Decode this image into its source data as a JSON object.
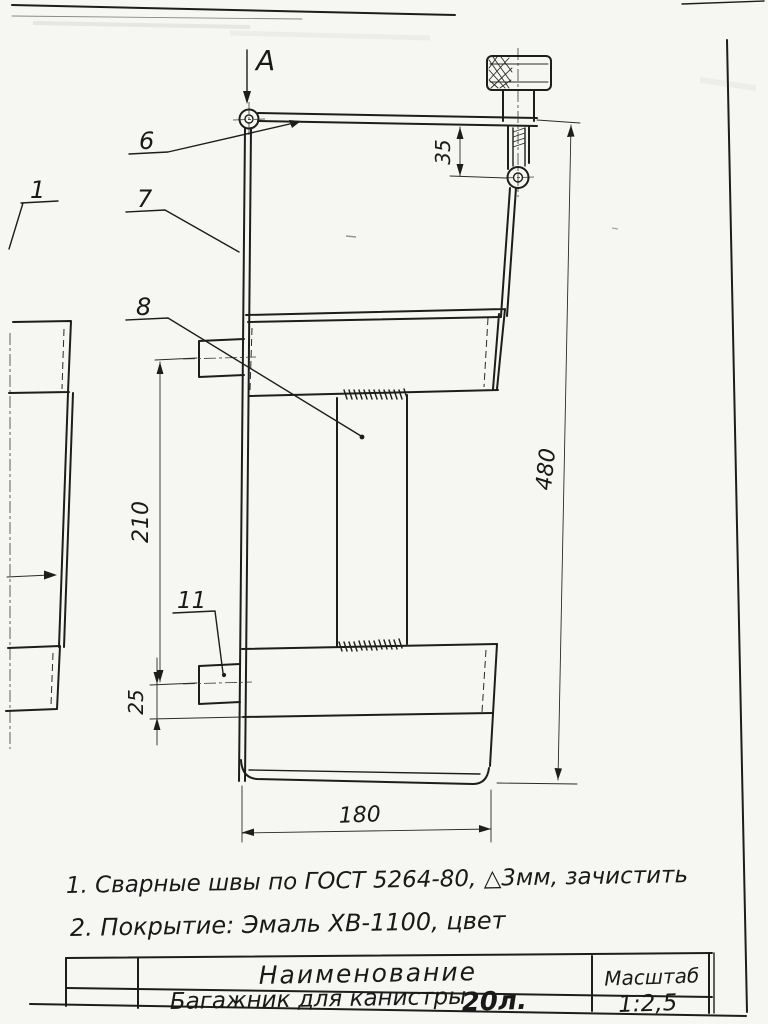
{
  "drawing": {
    "view_label": "A",
    "part_labels": {
      "p1": "1",
      "p6": "6",
      "p7": "7",
      "p8": "8",
      "p11": "11"
    },
    "dimensions": {
      "d35": "35",
      "d480": "480",
      "d210": "210",
      "d25": "25",
      "d180": "180"
    },
    "notes": {
      "line1": "1. Сварные швы по ГОСТ 5264-80, △3мм, зачистить",
      "line2": "2. Покрытие: Эмаль ХВ-1100, цвет"
    },
    "title_block": {
      "name_header": "Наименование",
      "name_value": "Багажник для канистры",
      "name_value_volume": "20л.",
      "scale_header": "Масштаб",
      "scale_value": "1:2,5"
    }
  }
}
